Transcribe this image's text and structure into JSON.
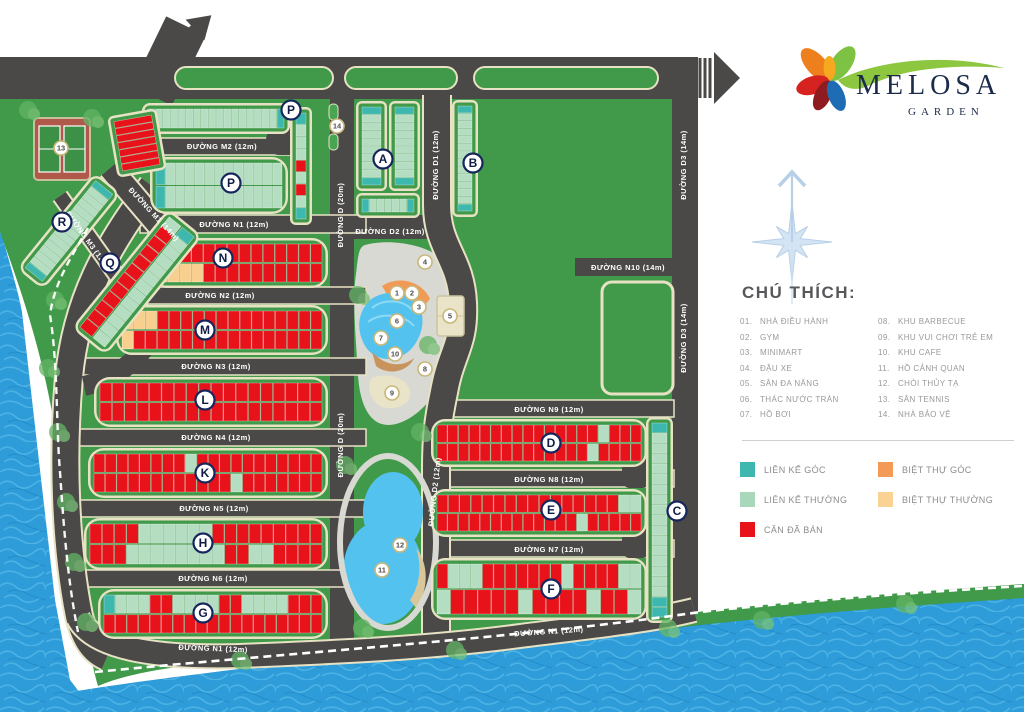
{
  "logo": {
    "name": "MELOSA",
    "subtitle": "GARDEN"
  },
  "legend": {
    "title": "CHÚ THÍCH:",
    "items_left": [
      {
        "num": "01.",
        "label": "NHÀ ĐIỀU HÀNH"
      },
      {
        "num": "02.",
        "label": "GYM"
      },
      {
        "num": "03.",
        "label": "MINIMART"
      },
      {
        "num": "04.",
        "label": "ĐẬU XE"
      },
      {
        "num": "05.",
        "label": "SÂN ĐA NĂNG"
      },
      {
        "num": "06.",
        "label": "THÁC NƯỚC TRÀN"
      },
      {
        "num": "07.",
        "label": "HỒ BƠI"
      }
    ],
    "items_right": [
      {
        "num": "08.",
        "label": "KHU BARBECUE"
      },
      {
        "num": "09.",
        "label": "KHU VUI CHƠI TRẺ EM"
      },
      {
        "num": "10.",
        "label": "KHU CAFE"
      },
      {
        "num": "11.",
        "label": "HỒ CẢNH QUAN"
      },
      {
        "num": "12.",
        "label": "CHÒI THỦY TẠ"
      },
      {
        "num": "13.",
        "label": "SÂN TENNIS"
      },
      {
        "num": "14.",
        "label": "NHÀ BẢO VỆ"
      }
    ],
    "swatches": [
      {
        "color": "#3EB8AF",
        "label": "LIÊN KẾ GÓC"
      },
      {
        "color": "#A8D8B9",
        "label": "LIÊN KẾ THƯỜNG"
      },
      {
        "color": "#E8121B",
        "label": "CĂN ĐÃ BÁN"
      },
      {
        "color": "#F49A58",
        "label": "BIỆT THỰ GÓC"
      },
      {
        "color": "#FAD293",
        "label": "BIỆT THỰ THƯỜNG"
      }
    ]
  },
  "map": {
    "palette": {
      "R": "#e8121b",
      "G": "#b4ddc1",
      "T": "#3eb8af",
      "Y": "#f8cf8e",
      "O": "#f2994e",
      "border": "#e8e2c4",
      "block_green": "#419a49",
      "land": "#419a49",
      "road": "#4a4948",
      "water": "#2d9cd9"
    },
    "road_labels": [
      {
        "text": "ĐƯỜNG M2 (12m)",
        "x": 222,
        "y": 149,
        "rot": 0
      },
      {
        "text": "ĐƯỜNG N1 (12m)",
        "x": 234,
        "y": 227,
        "rot": 0
      },
      {
        "text": "ĐƯỜNG M1 (14m)",
        "x": 152,
        "y": 216,
        "rot": 47
      },
      {
        "text": "ĐƯỜNG M3 (12m)",
        "x": 86,
        "y": 242,
        "rot": 54
      },
      {
        "text": "ĐƯỜNG N2 (12m)",
        "x": 220,
        "y": 298,
        "rot": 0
      },
      {
        "text": "ĐƯỜNG N3 (12m)",
        "x": 216,
        "y": 369,
        "rot": 0
      },
      {
        "text": "ĐƯỜNG N4 (12m)",
        "x": 216,
        "y": 440,
        "rot": 0
      },
      {
        "text": "ĐƯỜNG N5 (12m)",
        "x": 214,
        "y": 511,
        "rot": 0
      },
      {
        "text": "ĐƯỜNG N6 (12m)",
        "x": 213,
        "y": 581,
        "rot": 0
      },
      {
        "text": "ĐƯỜNG N1 (12m)",
        "x": 213,
        "y": 651,
        "rot": 2
      },
      {
        "text": "ĐƯỜNG D (20m)",
        "x": 343,
        "y": 215,
        "rot": -90
      },
      {
        "text": "ĐƯỜNG D (20m)",
        "x": 343,
        "y": 445,
        "rot": -90
      },
      {
        "text": "ĐƯỜNG D1 (12m)",
        "x": 438,
        "y": 165,
        "rot": -90
      },
      {
        "text": "ĐƯỜNG D2 (12m)",
        "x": 390,
        "y": 234,
        "rot": 0
      },
      {
        "text": "ĐƯỜNG D2 (12m)",
        "x": 437,
        "y": 492,
        "rot": -84
      },
      {
        "text": "ĐƯỜNG D3 (14m)",
        "x": 686,
        "y": 165,
        "rot": -90
      },
      {
        "text": "ĐƯỜNG D3 (14m)",
        "x": 686,
        "y": 338,
        "rot": -90
      },
      {
        "text": "ĐƯỜNG N10 (14m)",
        "x": 628,
        "y": 270,
        "rot": 0
      },
      {
        "text": "ĐƯỜNG N9 (12m)",
        "x": 549,
        "y": 412,
        "rot": 0
      },
      {
        "text": "ĐƯỜNG N8 (12m)",
        "x": 549,
        "y": 482,
        "rot": 0
      },
      {
        "text": "ĐƯỜNG N7 (12m)",
        "x": 549,
        "y": 552,
        "rot": 0
      },
      {
        "text": "ĐƯỜNG N1 (12m)",
        "x": 549,
        "y": 634,
        "rot": -4
      }
    ],
    "block_labels": [
      {
        "t": "A",
        "x": 383,
        "y": 159
      },
      {
        "t": "B",
        "x": 473,
        "y": 163
      },
      {
        "t": "C",
        "x": 677,
        "y": 511
      },
      {
        "t": "D",
        "x": 551,
        "y": 443
      },
      {
        "t": "E",
        "x": 551,
        "y": 510
      },
      {
        "t": "F",
        "x": 551,
        "y": 589
      },
      {
        "t": "G",
        "x": 203,
        "y": 613
      },
      {
        "t": "H",
        "x": 203,
        "y": 543
      },
      {
        "t": "K",
        "x": 205,
        "y": 473
      },
      {
        "t": "L",
        "x": 205,
        "y": 400
      },
      {
        "t": "M",
        "x": 205,
        "y": 330
      },
      {
        "t": "N",
        "x": 223,
        "y": 258
      },
      {
        "t": "P",
        "x": 291,
        "y": 110
      },
      {
        "t": "P",
        "x": 231,
        "y": 183
      },
      {
        "t": "Q",
        "x": 110,
        "y": 263
      },
      {
        "t": "R",
        "x": 62,
        "y": 222
      }
    ],
    "amenity_markers": [
      {
        "n": "1",
        "x": 397,
        "y": 293
      },
      {
        "n": "2",
        "x": 412,
        "y": 293
      },
      {
        "n": "3",
        "x": 419,
        "y": 307
      },
      {
        "n": "4",
        "x": 425,
        "y": 262
      },
      {
        "n": "5",
        "x": 450,
        "y": 316
      },
      {
        "n": "6",
        "x": 397,
        "y": 321
      },
      {
        "n": "7",
        "x": 381,
        "y": 338
      },
      {
        "n": "8",
        "x": 425,
        "y": 369
      },
      {
        "n": "9",
        "x": 392,
        "y": 393
      },
      {
        "n": "10",
        "x": 395,
        "y": 354
      },
      {
        "n": "11",
        "x": 382,
        "y": 570
      },
      {
        "n": "12",
        "x": 400,
        "y": 545
      },
      {
        "n": "13",
        "x": 61,
        "y": 148
      },
      {
        "n": "14",
        "x": 337,
        "y": 126
      }
    ],
    "strips": [
      {
        "id": "p-top",
        "x": 142,
        "y": 103,
        "w": 148,
        "h": 31,
        "rot": 0,
        "dir": "h",
        "rx": 8,
        "rows": [
          "T1,G16,T1"
        ]
      },
      {
        "id": "p-col",
        "x": 290,
        "y": 107,
        "w": 22,
        "h": 118,
        "rot": 0,
        "dir": "v",
        "rx": 6,
        "rows": [
          "T1,G3,R1,G1,R1,G1,T1"
        ]
      },
      {
        "id": "p-main",
        "x": 150,
        "y": 157,
        "w": 138,
        "h": 57,
        "rot": 0,
        "dir": "h",
        "rx": 16,
        "rows": [
          "T1,G12",
          "T1,G12"
        ]
      },
      {
        "id": "a1",
        "x": 356,
        "y": 101,
        "w": 31,
        "h": 90,
        "rot": 0,
        "dir": "v",
        "rx": 6,
        "rows": [
          "T1,G8,T1"
        ]
      },
      {
        "id": "a2",
        "x": 389,
        "y": 101,
        "w": 31,
        "h": 90,
        "rot": 0,
        "dir": "v",
        "rx": 6,
        "rows": [
          "T1,G8,T1"
        ]
      },
      {
        "id": "a3",
        "x": 356,
        "y": 193,
        "w": 64,
        "h": 25,
        "rot": 0,
        "dir": "h",
        "rx": 6,
        "rows": [
          "T1,G5,T1"
        ]
      },
      {
        "id": "b",
        "x": 452,
        "y": 100,
        "w": 26,
        "h": 117,
        "rot": 0,
        "dir": "v",
        "rx": 6,
        "rows": [
          "T1,G12,T1"
        ]
      },
      {
        "id": "c",
        "x": 646,
        "y": 417,
        "w": 27,
        "h": 206,
        "rot": 0,
        "dir": "v",
        "rx": 7,
        "rows": [
          "T1,G16,T2"
        ]
      },
      {
        "id": "d",
        "x": 431,
        "y": 419,
        "w": 216,
        "h": 48,
        "rot": 0,
        "dir": "h",
        "rx": 14,
        "rows": [
          "R15,G1,R3",
          "R14,G1,R4"
        ]
      },
      {
        "id": "e",
        "x": 431,
        "y": 489,
        "w": 216,
        "h": 48,
        "rot": 0,
        "dir": "h",
        "rx": 14,
        "rows": [
          "R16,G2",
          "R13,G1,R5"
        ]
      },
      {
        "id": "f",
        "x": 431,
        "y": 558,
        "w": 216,
        "h": 62,
        "rot": 0,
        "dir": "h",
        "rx": 14,
        "rows": [
          "R1,G3,R7,G1,R4,G2",
          "G1,R5,G1,R4,G1,R2,G1"
        ]
      },
      {
        "id": "n",
        "x": 150,
        "y": 238,
        "w": 178,
        "h": 50,
        "rot": 0,
        "dir": "h",
        "rx": 16,
        "rows": [
          "Y2,R12",
          "Y4,R10"
        ]
      },
      {
        "id": "m",
        "x": 116,
        "y": 305,
        "w": 212,
        "h": 50,
        "rot": 0,
        "dir": "h",
        "rx": 16,
        "rows": [
          "Y3,R14",
          "Y1,R16"
        ]
      },
      {
        "id": "l",
        "x": 94,
        "y": 377,
        "w": 234,
        "h": 50,
        "rot": 0,
        "dir": "h",
        "rx": 16,
        "rows": [
          "R18",
          "R18"
        ]
      },
      {
        "id": "k",
        "x": 88,
        "y": 448,
        "w": 240,
        "h": 50,
        "rot": 0,
        "dir": "h",
        "rx": 16,
        "rows": [
          "R8,G1,R11",
          "R12,G1,R7"
        ]
      },
      {
        "id": "h",
        "x": 84,
        "y": 518,
        "w": 244,
        "h": 52,
        "rot": 0,
        "dir": "h",
        "rx": 16,
        "rows": [
          "R4,G6,R9",
          "R3,G8,R2,G2,R4"
        ]
      },
      {
        "id": "g",
        "x": 98,
        "y": 589,
        "w": 230,
        "h": 50,
        "rot": 0,
        "dir": "h",
        "rx": 16,
        "rows": [
          "T1,G3,R2,G4,R2,G4,R3",
          "R19"
        ]
      },
      {
        "id": "r",
        "x": 7,
        "y": 214,
        "w": 124,
        "h": 34,
        "rot": -51,
        "dir": "h",
        "rx": 10,
        "rows": [
          "T1,G13,T1"
        ]
      },
      {
        "id": "q",
        "x": 60,
        "y": 260,
        "w": 154,
        "h": 44,
        "rot": -51,
        "dir": "h",
        "rx": 10,
        "rows": [
          "R11,G1",
          "G12,T1"
        ]
      },
      {
        "id": "m1-block",
        "x": 112,
        "y": 112,
        "w": 50,
        "h": 62,
        "rot": -10,
        "dir": "v",
        "rx": 6,
        "rows": [
          "R7"
        ]
      }
    ],
    "trees": [
      [
        28,
        110
      ],
      [
        92,
        118
      ],
      [
        55,
        300
      ],
      [
        48,
        368
      ],
      [
        58,
        432
      ],
      [
        66,
        502
      ],
      [
        74,
        562
      ],
      [
        86,
        622
      ],
      [
        358,
        295
      ],
      [
        428,
        345
      ],
      [
        345,
        465
      ],
      [
        420,
        432
      ],
      [
        362,
        628
      ],
      [
        240,
        660
      ],
      [
        455,
        650
      ],
      [
        668,
        628
      ],
      [
        762,
        620
      ],
      [
        905,
        604
      ]
    ]
  }
}
